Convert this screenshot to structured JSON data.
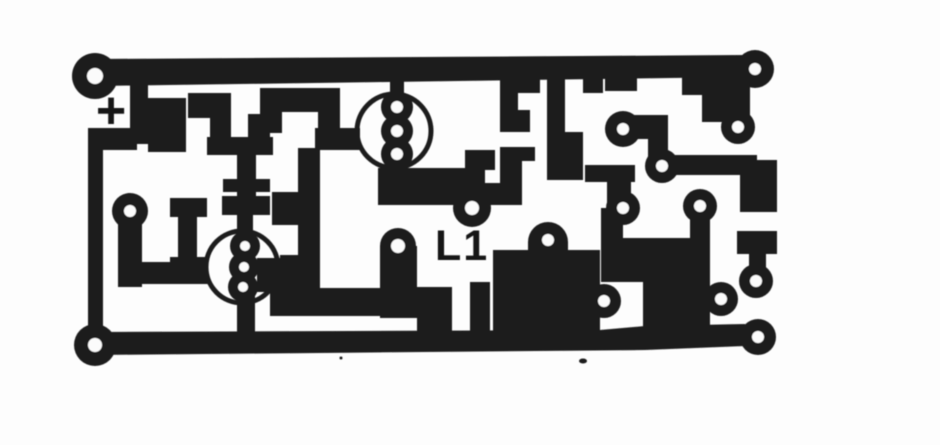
{
  "image": {
    "description": "Scanned black-and-white printed circuit board copper track layout",
    "labels": {
      "polarity": "+",
      "inductor": "L1"
    },
    "colors": {
      "trace_black": "#1c1c1c",
      "paper_white": "#fdfdfd"
    }
  }
}
